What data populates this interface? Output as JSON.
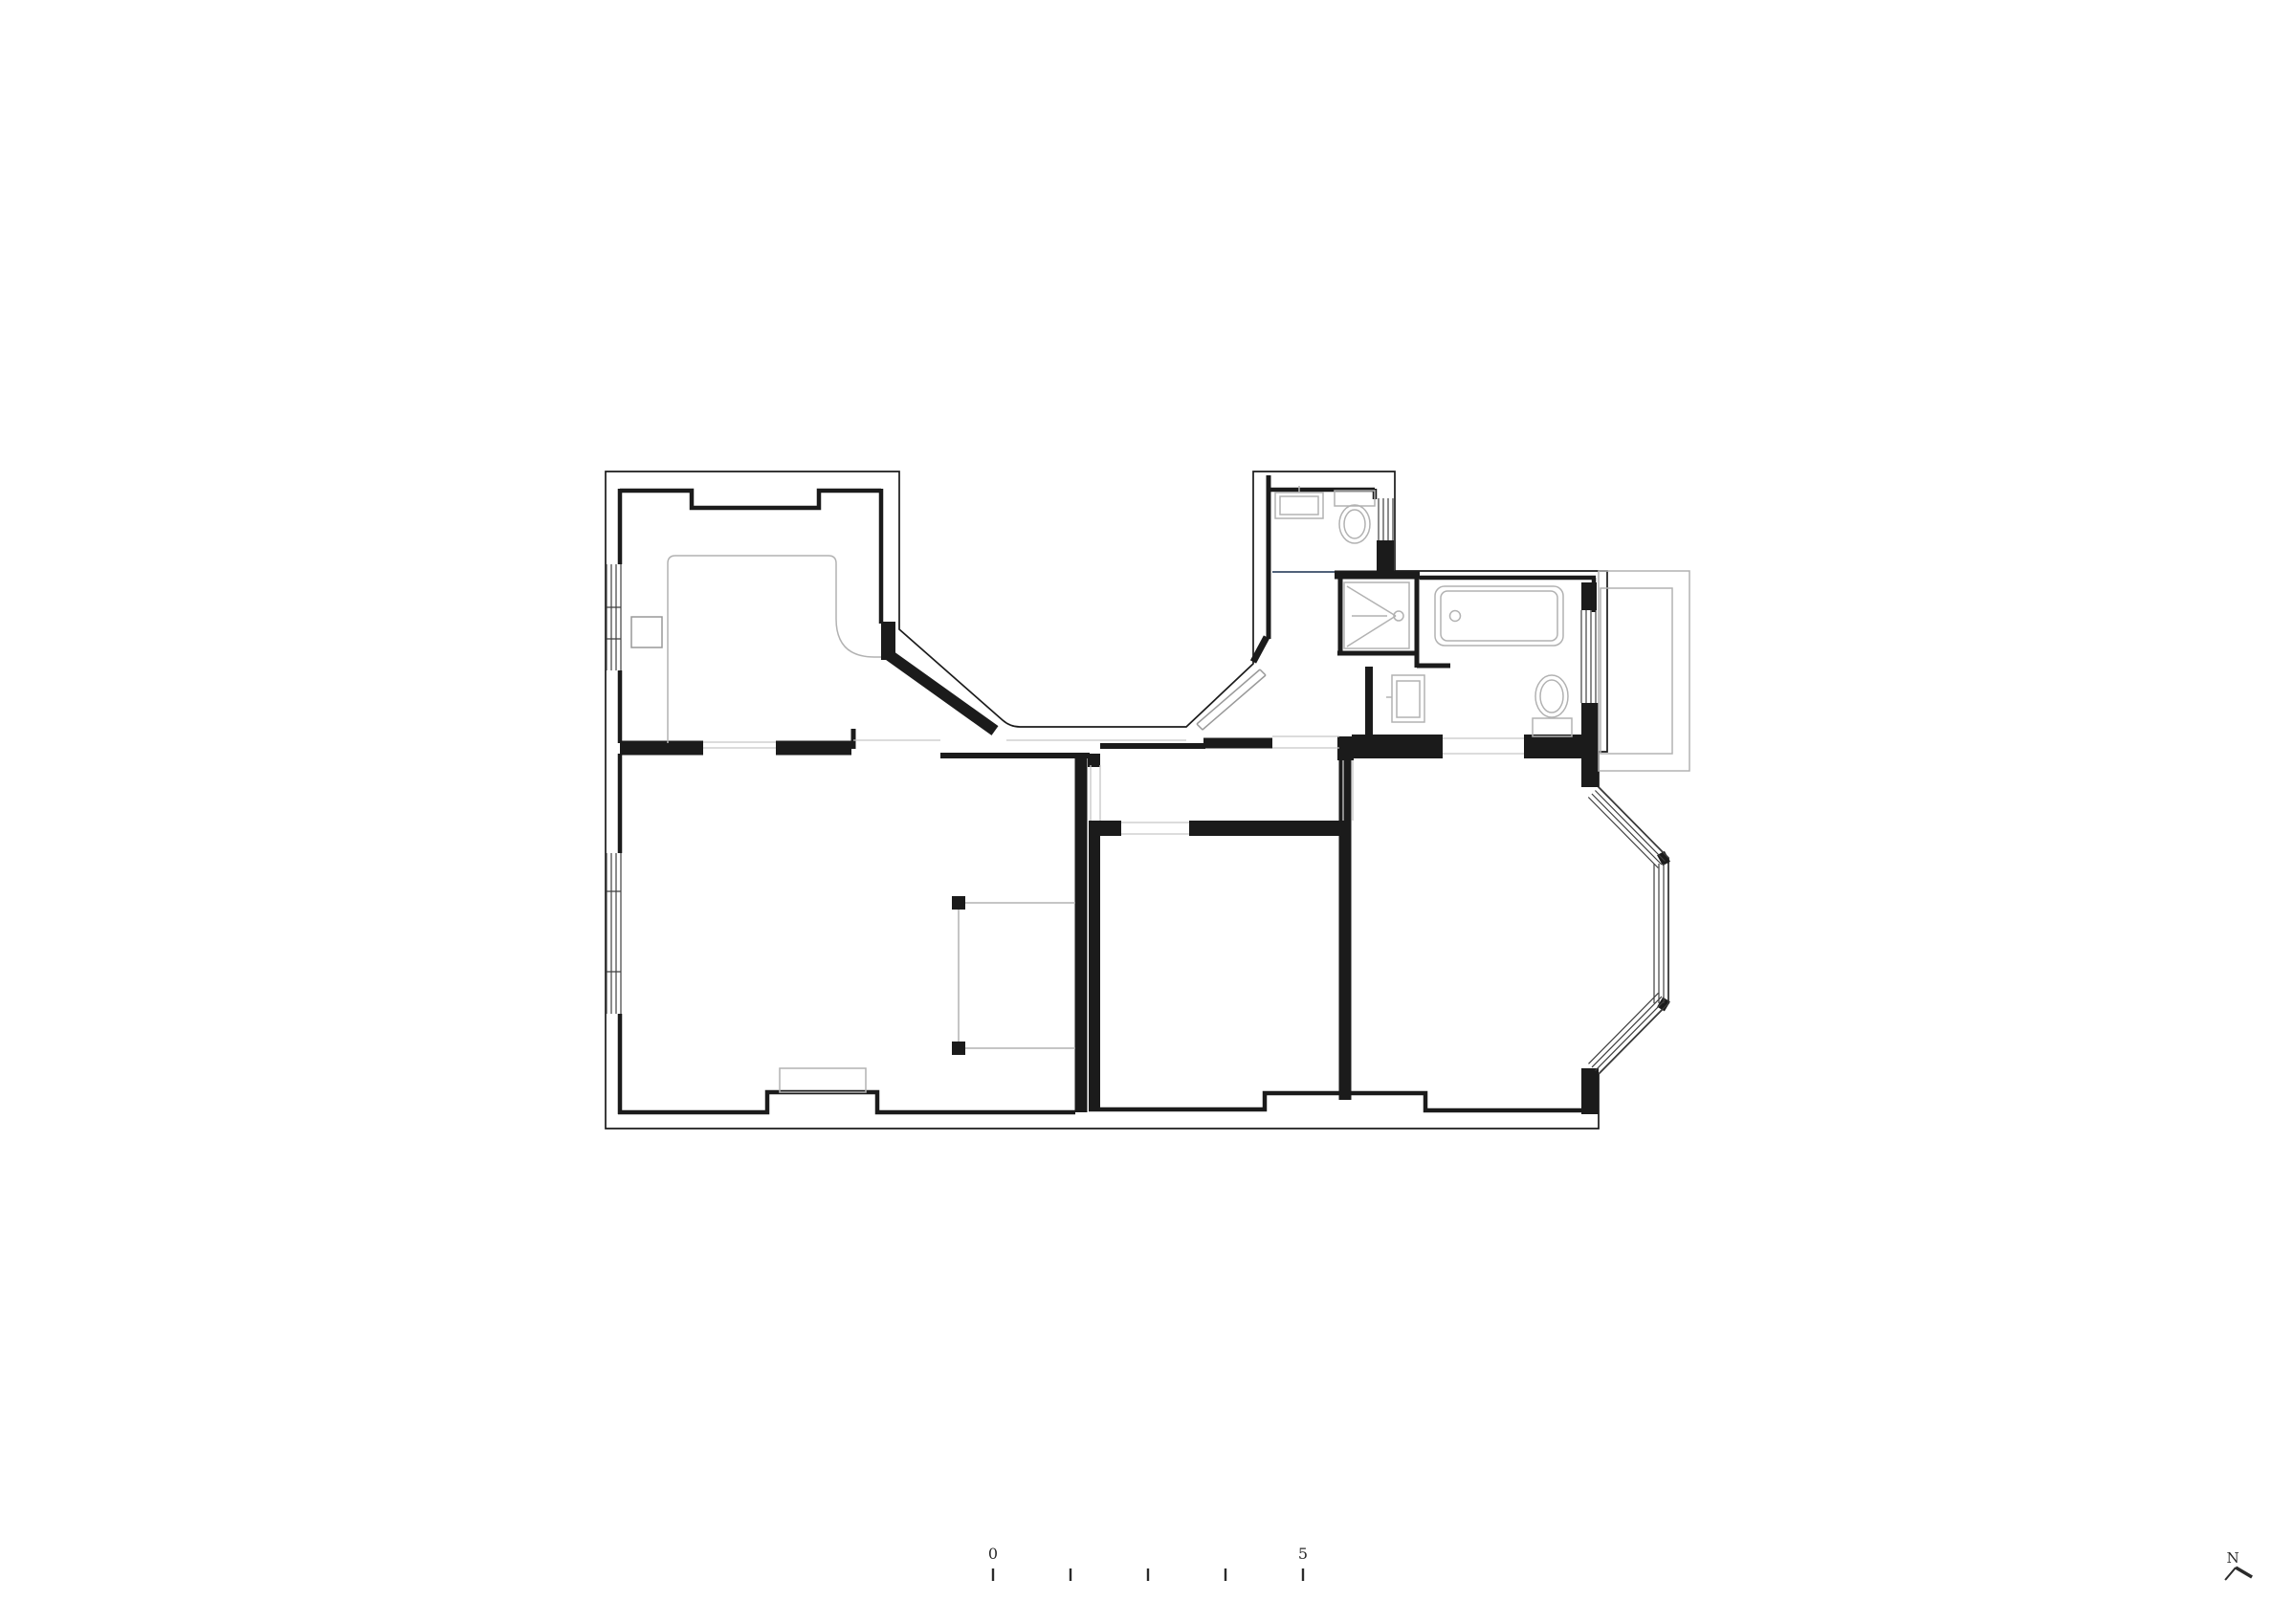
{
  "document": {
    "type": "architectural floor plan",
    "content": "apartment plan with bedroom, living room, two rooms, hallway, WC, shower room, bathroom, balcony and bay window"
  },
  "colors": {
    "wall": "#1b1b1b",
    "window": "#3f3f3f",
    "fixture": "#b2b2b2",
    "furniture": "#b2b2b2",
    "threshold": "#c6c6c6",
    "glass_partition": "#51627a",
    "text": "#2b2b2b",
    "paper": "#ffffff"
  },
  "scale_bar": {
    "start_label": "0",
    "end_label": "5",
    "tick_count": 5
  },
  "compass": {
    "north_label": "N"
  }
}
